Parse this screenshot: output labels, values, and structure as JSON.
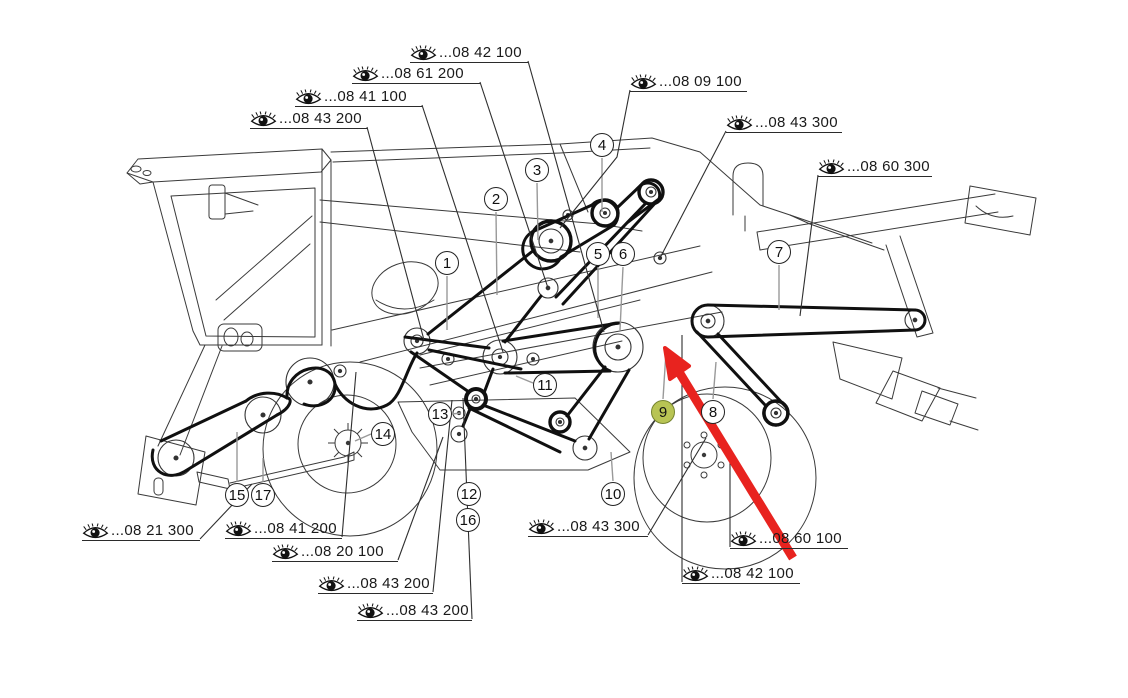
{
  "diagram": {
    "description": "Combine harvester side view belt-drive parts diagram",
    "colors": {
      "line": "#3a3a3a",
      "belt": "#101010",
      "arrow": "#e8231f",
      "highlight_fill": "#b8c454",
      "highlight_border": "#76842f"
    },
    "icons": {
      "label_icon": "eye-icon"
    },
    "part_labels": [
      {
        "code": "...08 42 100",
        "x1": 410,
        "x2": 528,
        "y": 61,
        "leader": [
          [
            528,
            61
          ],
          [
            604,
            332
          ]
        ]
      },
      {
        "code": "...08 61 200",
        "x1": 352,
        "x2": 480,
        "y": 82,
        "leader": [
          [
            480,
            82
          ],
          [
            548,
            288
          ]
        ]
      },
      {
        "code": "...08 41 100",
        "x1": 295,
        "x2": 422,
        "y": 105,
        "leader": [
          [
            422,
            105
          ],
          [
            503,
            352
          ]
        ]
      },
      {
        "code": "...08 43 200",
        "x1": 250,
        "x2": 367,
        "y": 127,
        "leader": [
          [
            367,
            127
          ],
          [
            424,
            340
          ]
        ]
      },
      {
        "code": "...08 09 100",
        "x1": 630,
        "x2": 747,
        "y": 90,
        "leader": [
          [
            630,
            90
          ],
          [
            617,
            157
          ],
          [
            560,
            228
          ]
        ]
      },
      {
        "code": "...08 43 300",
        "x1": 726,
        "x2": 842,
        "y": 131,
        "leader": [
          [
            726,
            131
          ],
          [
            660,
            258
          ]
        ]
      },
      {
        "code": "...08 60 300",
        "x1": 818,
        "x2": 932,
        "y": 175,
        "leader": [
          [
            818,
            175
          ],
          [
            800,
            316
          ]
        ]
      },
      {
        "code": "...08 21 300",
        "x1": 82,
        "x2": 200,
        "y": 539,
        "leader": [
          [
            200,
            539
          ],
          [
            252,
            484
          ]
        ]
      },
      {
        "code": "...08 41 200",
        "x1": 225,
        "x2": 342,
        "y": 537,
        "leader": [
          [
            342,
            537
          ],
          [
            356,
            372
          ]
        ]
      },
      {
        "code": "...08 20 100",
        "x1": 272,
        "x2": 398,
        "y": 560,
        "leader": [
          [
            398,
            560
          ],
          [
            443,
            437
          ]
        ]
      },
      {
        "code": "...08 43 200",
        "x1": 318,
        "x2": 433,
        "y": 592,
        "leader": [
          [
            433,
            592
          ],
          [
            452,
            400
          ]
        ]
      },
      {
        "code": "...08 43 200",
        "x1": 357,
        "x2": 472,
        "y": 619,
        "leader": [
          [
            472,
            619
          ],
          [
            463,
            398
          ]
        ]
      },
      {
        "code": "...08 43 300",
        "x1": 528,
        "x2": 648,
        "y": 535,
        "leader": [
          [
            648,
            535
          ],
          [
            706,
            438
          ]
        ]
      },
      {
        "code": "...08 60 100",
        "x1": 730,
        "x2": 848,
        "y": 547,
        "leader": [
          [
            730,
            547
          ],
          [
            730,
            452
          ]
        ]
      },
      {
        "code": "...08 42 100",
        "x1": 682,
        "x2": 800,
        "y": 582,
        "leader": [
          [
            682,
            582
          ],
          [
            682,
            335
          ]
        ]
      }
    ],
    "callouts": [
      {
        "n": "1",
        "x": 447,
        "y": 263
      },
      {
        "n": "2",
        "x": 496,
        "y": 199
      },
      {
        "n": "3",
        "x": 537,
        "y": 170
      },
      {
        "n": "4",
        "x": 602,
        "y": 145
      },
      {
        "n": "5",
        "x": 598,
        "y": 254
      },
      {
        "n": "6",
        "x": 623,
        "y": 254
      },
      {
        "n": "7",
        "x": 779,
        "y": 252
      },
      {
        "n": "8",
        "x": 713,
        "y": 412
      },
      {
        "n": "9",
        "x": 663,
        "y": 412,
        "highlight": true
      },
      {
        "n": "10",
        "x": 613,
        "y": 494
      },
      {
        "n": "11",
        "x": 545,
        "y": 385
      },
      {
        "n": "12",
        "x": 469,
        "y": 494
      },
      {
        "n": "13",
        "x": 440,
        "y": 414
      },
      {
        "n": "14",
        "x": 383,
        "y": 434
      },
      {
        "n": "15",
        "x": 237,
        "y": 495
      },
      {
        "n": "16",
        "x": 468,
        "y": 520
      },
      {
        "n": "17",
        "x": 263,
        "y": 495
      }
    ]
  }
}
